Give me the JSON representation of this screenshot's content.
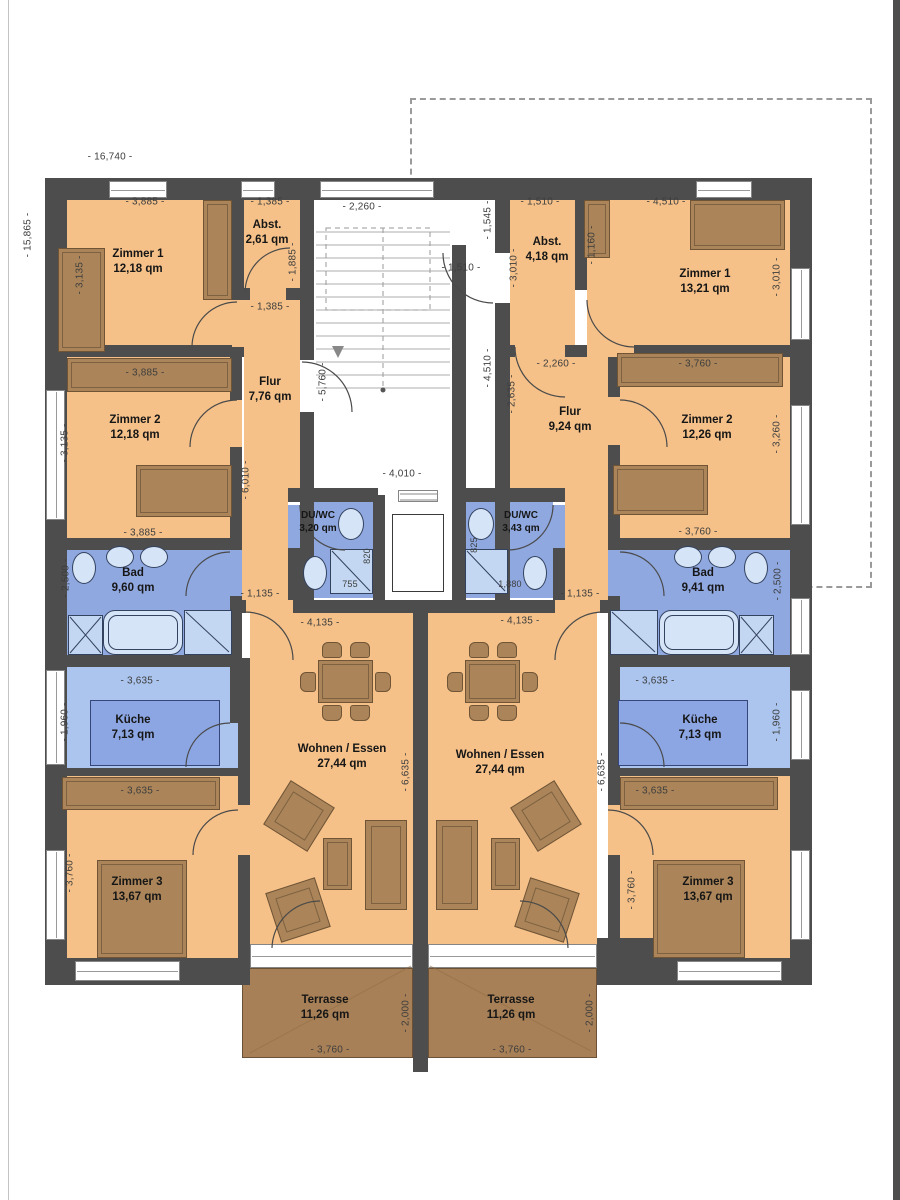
{
  "plan_type": "floor-plan",
  "colors": {
    "wall": "#4d4d4d",
    "floor": "#f5c189",
    "wet_room": "#8fa8e0",
    "wet_room_light": "#abc5ee",
    "furniture": "#ab8559",
    "terrace": "#a88057",
    "fixture": "#d6e4f7",
    "dimension_text": "#3d3d3d"
  },
  "rooms": {
    "l_zimmer1": {
      "name": "Zimmer 1",
      "area": "12,18 qm"
    },
    "l_zimmer2": {
      "name": "Zimmer 2",
      "area": "12,18 qm"
    },
    "l_zimmer3": {
      "name": "Zimmer 3",
      "area": "13,67 qm"
    },
    "l_abst": {
      "name": "Abst.",
      "area": "2,61 qm"
    },
    "l_flur": {
      "name": "Flur",
      "area": "7,76 qm"
    },
    "l_bad": {
      "name": "Bad",
      "area": "9,60 qm"
    },
    "l_duwc": {
      "name": "DU/WC",
      "area": "3,20 qm"
    },
    "l_kueche": {
      "name": "Küche",
      "area": "7,13 qm"
    },
    "l_wohnen": {
      "name": "Wohnen / Essen",
      "area": "27,44 qm"
    },
    "l_terrasse": {
      "name": "Terrasse",
      "area": "11,26 qm"
    },
    "r_zimmer1": {
      "name": "Zimmer 1",
      "area": "13,21 qm"
    },
    "r_zimmer2": {
      "name": "Zimmer 2",
      "area": "12,26 qm"
    },
    "r_zimmer3": {
      "name": "Zimmer 3",
      "area": "13,67 qm"
    },
    "r_abst": {
      "name": "Abst.",
      "area": "4,18 qm"
    },
    "r_flur": {
      "name": "Flur",
      "area": "9,24 qm"
    },
    "r_bad": {
      "name": "Bad",
      "area": "9,41 qm"
    },
    "r_duwc": {
      "name": "DU/WC",
      "area": "3,43 qm"
    },
    "r_kueche": {
      "name": "Küche",
      "area": "7,13 qm"
    },
    "r_wohnen": {
      "name": "Wohnen / Essen",
      "area": "27,44 qm"
    },
    "r_terrasse": {
      "name": "Terrasse",
      "area": "11,26 qm"
    }
  },
  "dims": {
    "overall_width": "- 16,740 -",
    "overall_height": "- 15,865 -",
    "l_zimmer1_w": "- 3,885 -",
    "l_zimmer1_h": "- 3,135 -",
    "l_abst_w": "- 1,385 -",
    "l_abst_h": "- 1,885 -",
    "l_abst_door": "- 1,385 -",
    "l_zimmer2_w": "- 3,885 -",
    "l_zimmer2_h": "- 3,135 -",
    "l_flur_h": "- 6,010 -",
    "l_bad_w": "- 3,885 -",
    "l_bad_h": "- 2,500 -",
    "l_kueche_w": "- 3,635 -",
    "l_kueche_h": "- 1,960 -",
    "l_sideboard_w": "- 3,635 -",
    "l_zimmer3_h": "- 3,760 -",
    "l_entry_w": "- 1,135 -",
    "l_shower_w": "755",
    "l_shower_h": "820",
    "l_wohnen_w": "- 4,135 -",
    "l_wohnen_h": "- 6,635 -",
    "l_terrasse_w": "- 3,760 -",
    "l_terrasse_h": "- 2,000 -",
    "stair_top_w": "- 2,260 -",
    "stair_h": "- 5,760 -",
    "stair_bottom_w": "- 4,010 -",
    "stair_recess_h": "- 1,545 -",
    "stair_door_w": "- 1,510 -",
    "stair_side_h": "- 4,510 -",
    "r_abst_w": "- 1,510 -",
    "r_abst_h": "- 3,010 -",
    "r_wardrobe_h": "- 1,160 -",
    "r_zimmer1_w": "- 4,510 -",
    "r_zimmer1_h": "- 3,010 -",
    "r_flur_w": "- 2,260 -",
    "r_flur_h": "- 2,635 -",
    "r_zimmer2_w": "- 3,760 -",
    "r_zimmer2_h": "- 3,260 -",
    "r_bad_w": "- 3,760 -",
    "r_bad_h": "- 2,500 -",
    "r_kueche_w": "- 3,635 -",
    "r_kueche_h": "- 1,960 -",
    "r_sideboard_w": "- 3,635 -",
    "r_zimmer3_h": "- 3,760 -",
    "r_entry_w": "- 1,135 -",
    "r_shower_w": "1,880",
    "r_shower_h": "825",
    "r_wohnen_w": "- 4,135 -",
    "r_wohnen_h": "- 6,635 -",
    "r_terrasse_w": "- 3,760 -",
    "r_terrasse_h": "- 2,000 -"
  }
}
